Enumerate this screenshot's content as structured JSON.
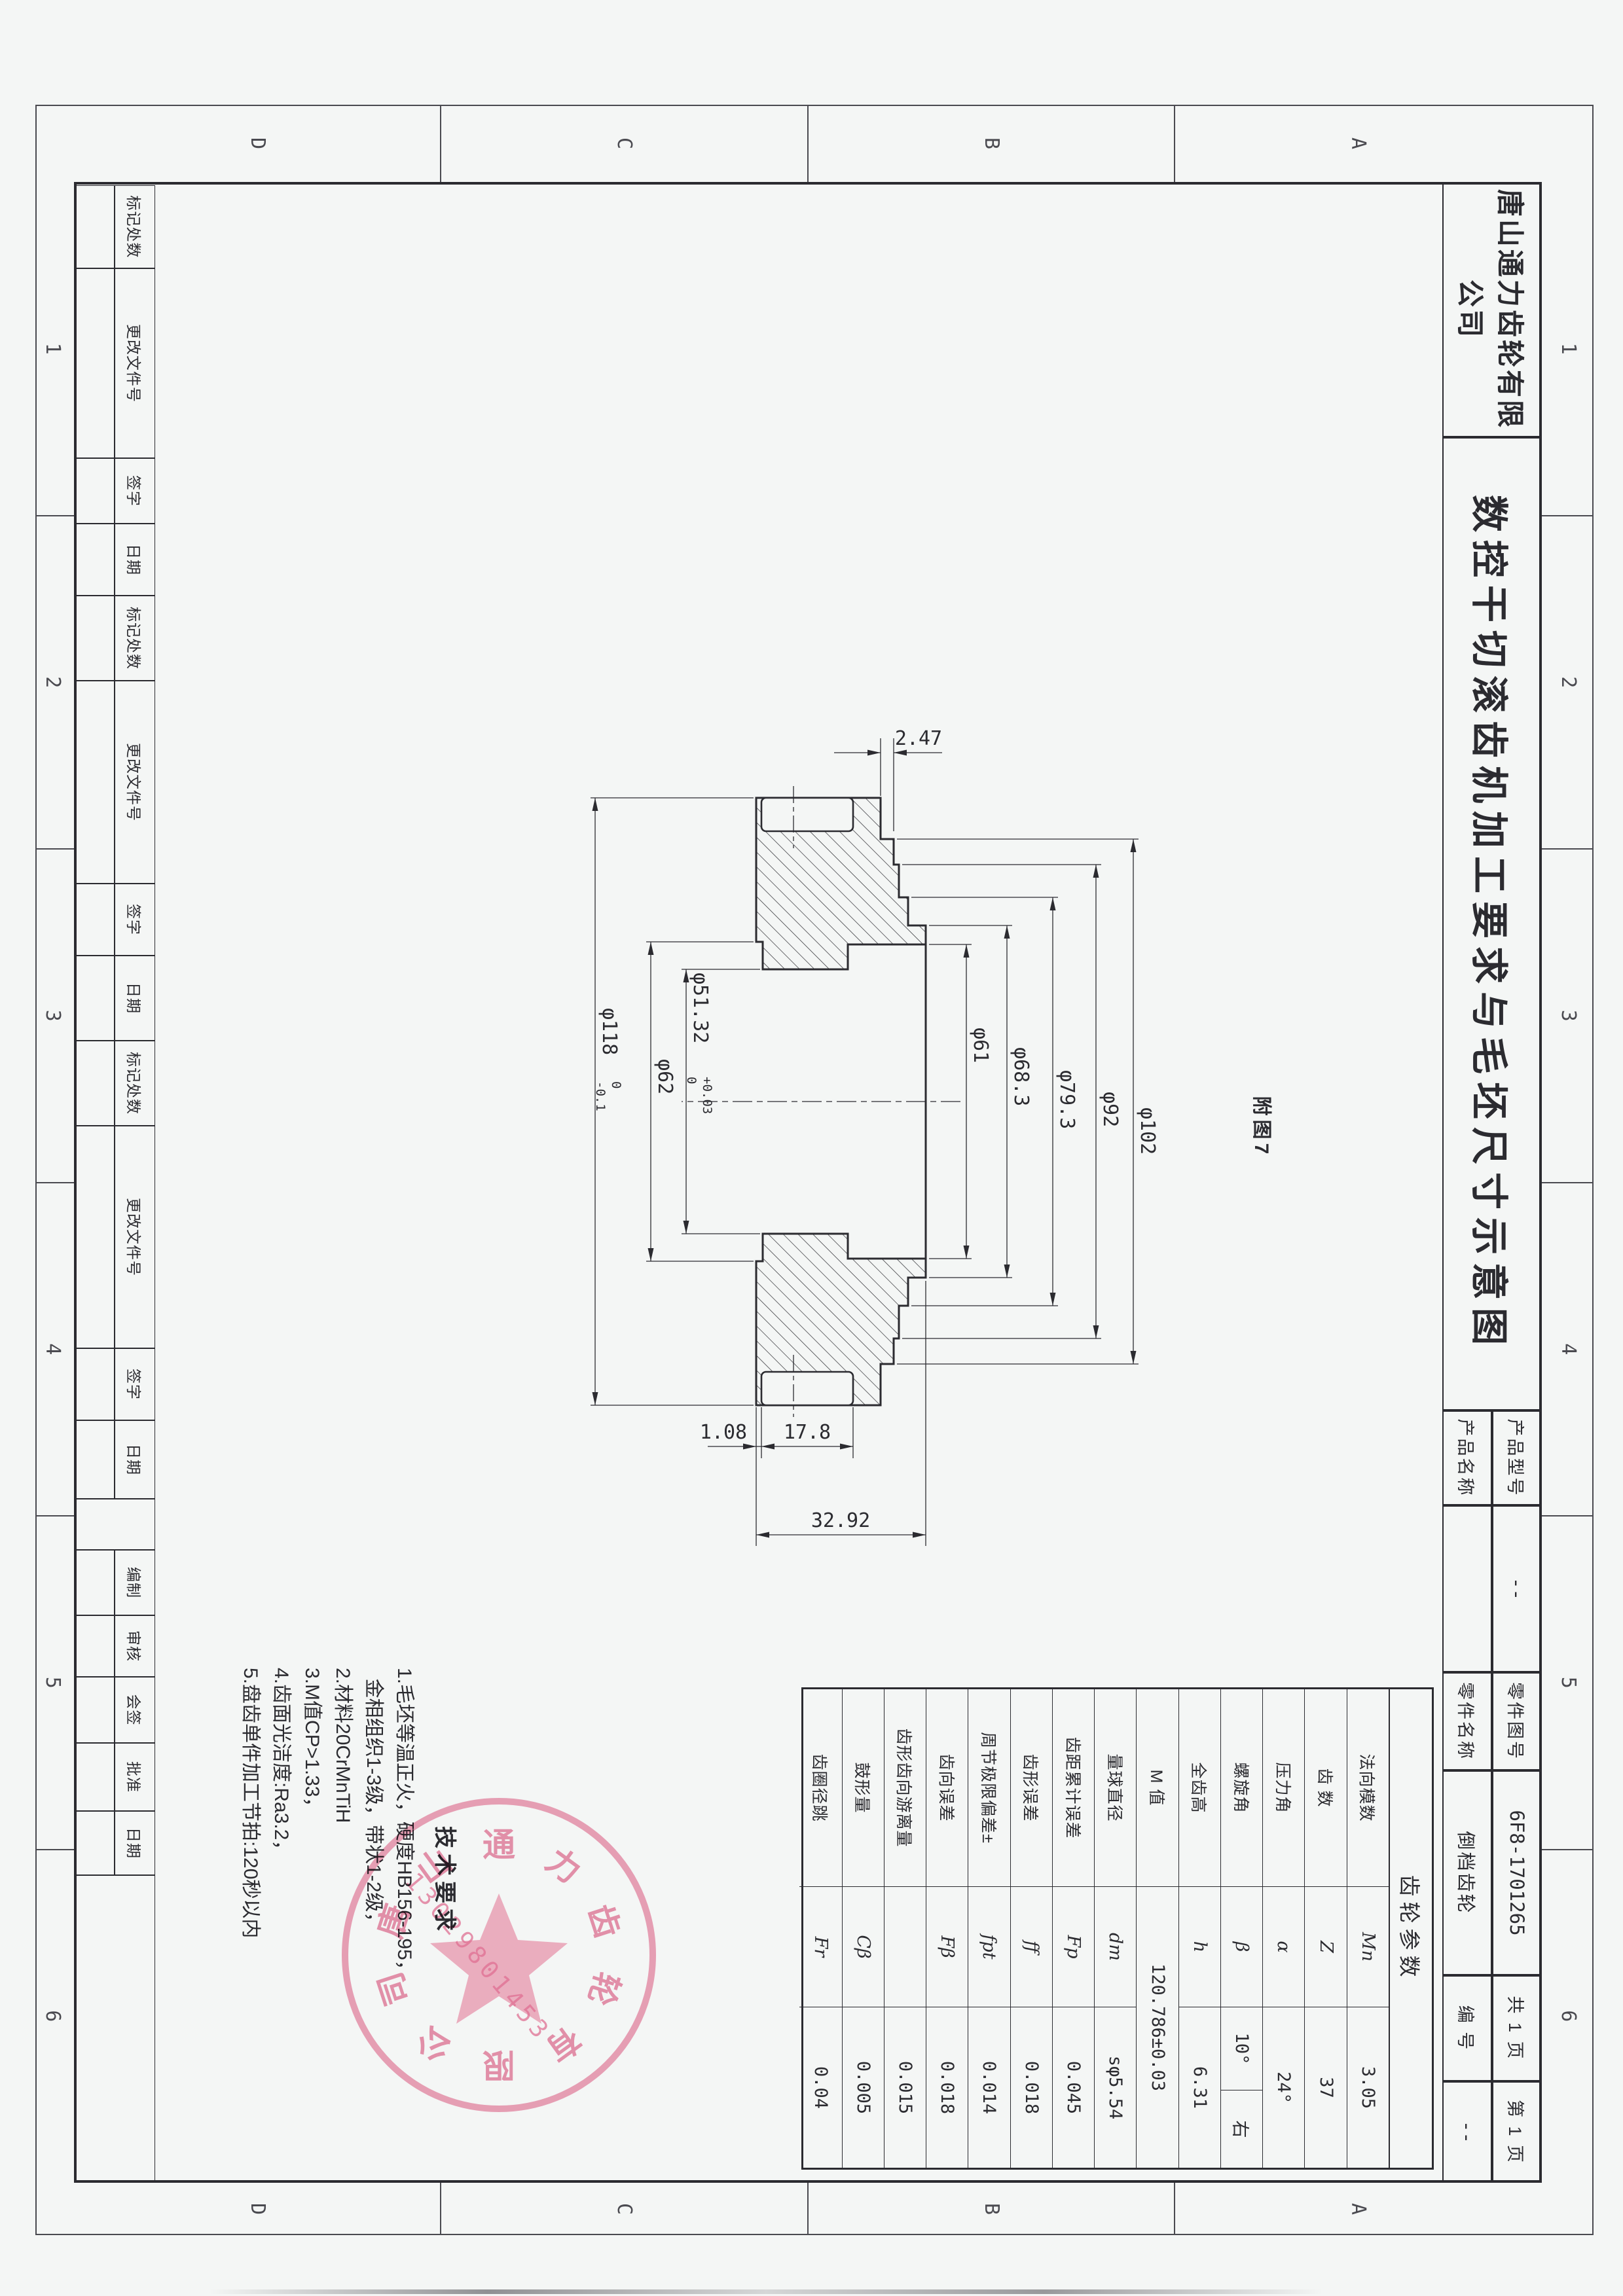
{
  "sheet": {
    "company": "唐山通力齿轮有限公司",
    "title": "数控干切滚齿机加工要求与毛坯尺寸示意图",
    "figure_label": "附图7",
    "ink_color": "#2b2b30",
    "paper_color": "#f4f6f5"
  },
  "title_block": {
    "product_model_label": "产品型号",
    "product_model_value": "--",
    "product_name_label": "产品名称",
    "product_name_value": "",
    "part_no_label": "零件图号",
    "part_no_value": "6F8-1701265",
    "part_name_label": "零件名称",
    "part_name_value": "倒档齿轮",
    "pages_total": "共 1 页",
    "page_no": "第 1 页",
    "serial_label": "编 号",
    "serial_value": "--"
  },
  "gear_params": {
    "header": "齿轮参数",
    "rows": [
      {
        "name": "法向模数",
        "symbol": "Mn",
        "value": "3.05"
      },
      {
        "name": "齿  数",
        "symbol": "Z",
        "value": "37"
      },
      {
        "name": "压力角",
        "symbol": "α",
        "value": "24°"
      },
      {
        "name": "螺旋角",
        "symbol": "β",
        "value": "10°",
        "value2": "右"
      },
      {
        "name": "全齿高",
        "symbol": "h",
        "value": "6.31"
      },
      {
        "name": "M 值",
        "symbol": "",
        "value": "120.786±0.03",
        "merge": true
      },
      {
        "name": "量球直径",
        "symbol": "dm",
        "value": "sφ5.54"
      },
      {
        "name": "齿距累计误差",
        "symbol": "Fp",
        "value": "0.045"
      },
      {
        "name": "齿形误差",
        "symbol": "ff",
        "value": "0.018"
      },
      {
        "name": "周节极限偏差±",
        "symbol": "fpt",
        "value": "0.014"
      },
      {
        "name": "齿向误差",
        "symbol": "Fβ",
        "value": "0.018"
      },
      {
        "name": "齿形齿向游离量",
        "symbol": "",
        "value": "0.015"
      },
      {
        "name": "鼓形量",
        "symbol": "Cβ",
        "value": "0.005"
      },
      {
        "name": "齿圈径跳",
        "symbol": "Fr",
        "value": "0.04"
      }
    ]
  },
  "tech_requirements": {
    "title": "技术要求",
    "lines": [
      "1.毛坯等温正火，硬度HB156-195，",
      "  金相组织1-3级，带状1-2级，",
      "2.材料20CrMnTiH",
      "3.M值CP>1.33，",
      "4.齿面光洁度:Ra3.2，",
      "5.盘齿单件加工节拍:120秒以内"
    ]
  },
  "dimensions": {
    "axial_total": "32.92",
    "teeth_width": "17.8",
    "teeth_offset": "1.08",
    "rim_step": "2.47",
    "d61": "φ61",
    "d683": "φ68.3",
    "d793": "φ79.3",
    "d92": "φ92",
    "d102": "φ102",
    "d62": "φ62",
    "d118": {
      "v": "φ118",
      "tol_top": "0",
      "tol_bot": "-0.1"
    },
    "d5132": {
      "v": "φ51.32",
      "tol_top": "+0.03",
      "tol_bot": "0"
    }
  },
  "revision_strip": {
    "labels": [
      "标记处数",
      "更改文件号",
      "签字",
      "日期"
    ],
    "repeats": 3
  },
  "signature_strip": {
    "labels": [
      "编制",
      "审核",
      "会签",
      "批准",
      "日期"
    ]
  },
  "zones": {
    "letters": [
      "A",
      "B",
      "C",
      "D"
    ],
    "numbers": [
      "1",
      "2",
      "3",
      "4",
      "5",
      "6"
    ]
  },
  "stamp": {
    "ring_text": "唐山通力齿轮有限公司",
    "phone": "13029801453",
    "color": "#e97d9e"
  }
}
